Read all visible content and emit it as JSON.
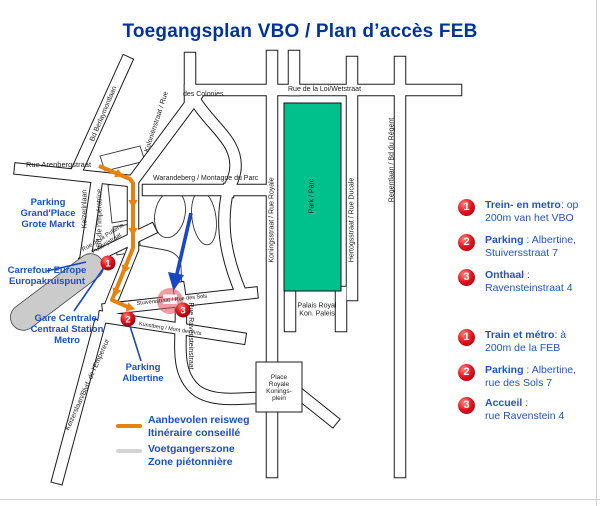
{
  "title": "Toegangsplan VBO / Plan d’accès FEB",
  "colors": {
    "title_navy": "#0033a0",
    "label_blue": "#1a4fc8",
    "route_orange": "#e8820e",
    "park_green": "#00c08c",
    "marker_red": "#e1121c",
    "pedestrian_grey": "#cbcbcb"
  },
  "map": {
    "streets": {
      "loi": "Rue de la Loi/Wetstraat",
      "colonies": "des Colonies",
      "kolonien": "Koloniënstraat / Rue",
      "berlaymont": "Bd Berlaymontlaan",
      "arenberg": "Rue Arenbergstraat",
      "warandeberg": "Warandeberg / Montagne du Parc",
      "keizerinlaan": "Keizerinlaan",
      "imperatrice": "Bd de l'Impératrice",
      "putterie1": "Rue de la Putterie",
      "putterie2": "Putterijstraat",
      "royale": "Koningsstraat / Rue Royale",
      "park": "Park / Parc",
      "ducale": "Hertogsstraat / Rue Ducale",
      "regent": "Regentlaan / Bd du Régent",
      "ravenstein": "Rue Ravensteinstraat",
      "sols": "Stuiversstraat / Rue des Sols",
      "montdesarts": "Kunstberg / Mont des Arts",
      "empereur": "Keizerslaan/Blvd. de l'Empereur",
      "palais1": "Palais Royal",
      "palais2": "Kon. Paleis",
      "place1": "Place",
      "place2": "Royale",
      "place3": "Konings-",
      "place4": "plein"
    },
    "pois": {
      "parking_gp": [
        "Parking",
        "Grand'Place",
        "Grote Markt"
      ],
      "carrefour": [
        "Carrefour Europe",
        "Europakruispunt"
      ],
      "gare": [
        "Gare Centrale/",
        "Centraal Station",
        "Metro"
      ],
      "albertine": [
        "Parking",
        "Albertine"
      ]
    },
    "markers": {
      "m1": "1",
      "m2": "2",
      "m3": "3"
    }
  },
  "map_legend": {
    "route_nl": "Aanbevolen reisweg",
    "route_fr": "Itinéraire conseillé",
    "zone_nl": "Voetgangerszone",
    "zone_fr": "Zone piétonnière"
  },
  "sidebar": {
    "nl": [
      {
        "num": "1",
        "name": "Trein- en metro",
        "rest": ":  op",
        "line2": "200m van het VBO"
      },
      {
        "num": "2",
        "name": "Parking",
        "rest": " : Albertine,",
        "line2": "Stuiversstraat 7"
      },
      {
        "num": "3",
        "name": "Onthaal",
        "rest": " :",
        "line2": "Ravensteinstraat 4"
      }
    ],
    "fr": [
      {
        "num": "1",
        "name": "Train et métro",
        "rest": ": à",
        "line2": "200m de la FEB"
      },
      {
        "num": "2",
        "name": "Parking",
        "rest": " : Albertine,",
        "line2": "rue des Sols 7"
      },
      {
        "num": "3",
        "name": "Accueil",
        "rest": " :",
        "line2": "rue Ravenstein 4"
      }
    ]
  }
}
